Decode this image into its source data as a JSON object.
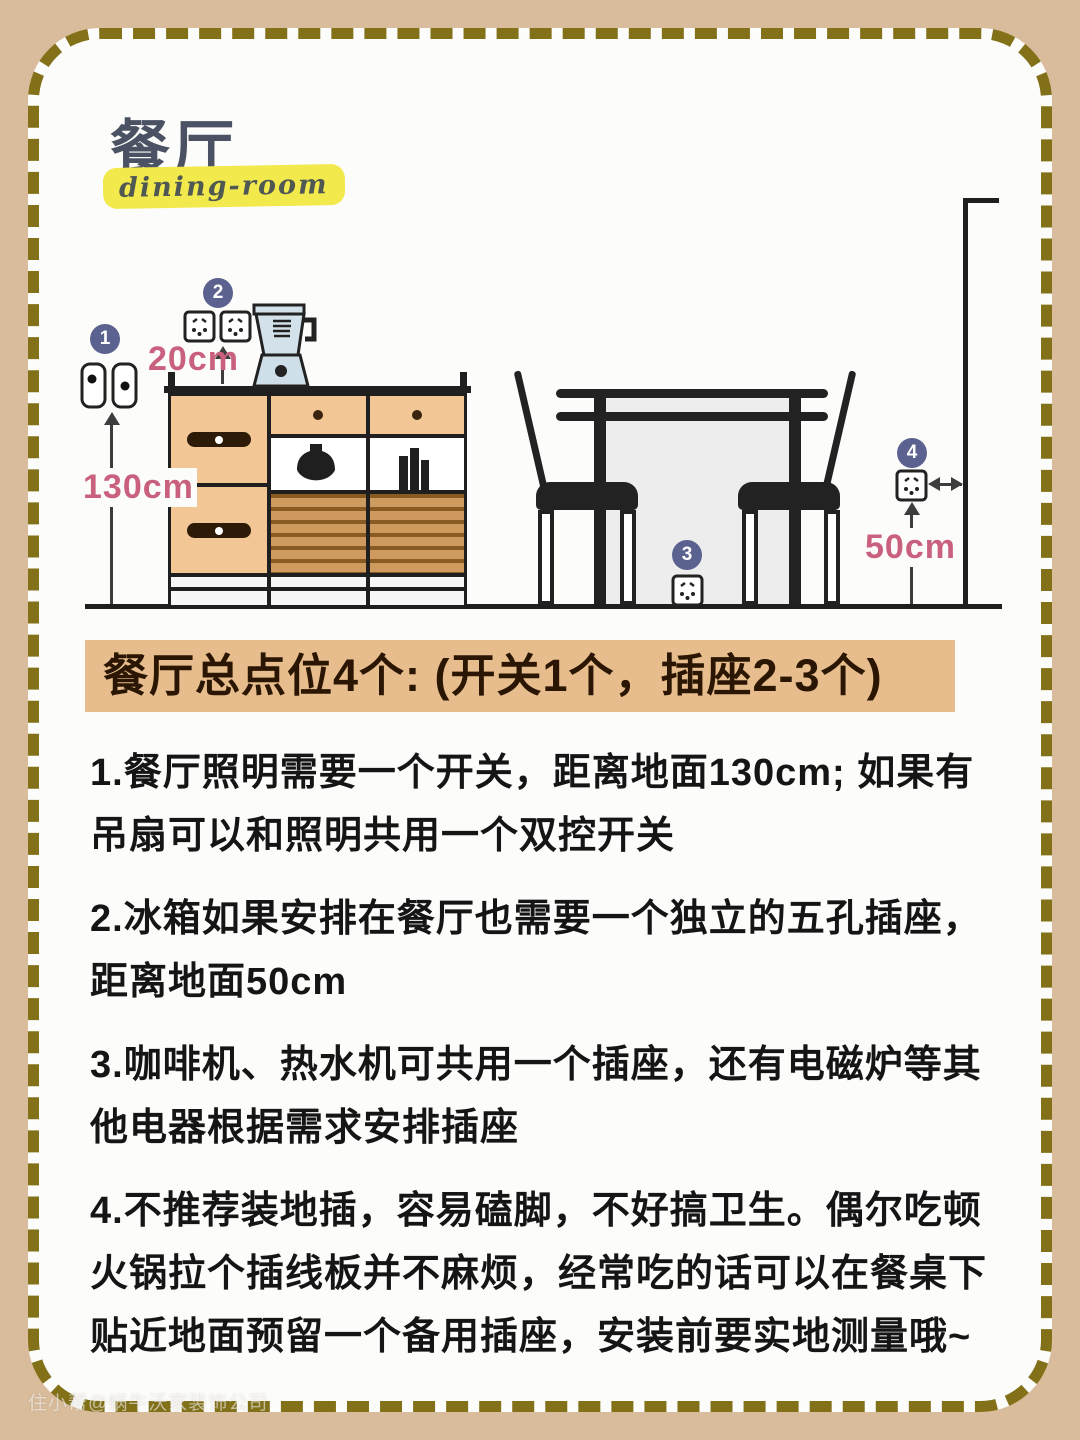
{
  "page": {
    "title": "餐厅",
    "subtitle": "dining-room",
    "watermark": "住小帮@蜗牛沃家装饰公司"
  },
  "banner": {
    "text": "餐厅总点位4个: (开关1个，插座2-3个)"
  },
  "diagram": {
    "markers": [
      {
        "num": "1",
        "meaning": "餐厅照明开关"
      },
      {
        "num": "2",
        "meaning": "柜上插座"
      },
      {
        "num": "3",
        "meaning": "餐桌下备用插座"
      },
      {
        "num": "4",
        "meaning": "冰箱五孔插座"
      }
    ],
    "measurements": {
      "switch_height": "130cm",
      "outlet_above_cabinet": "20cm",
      "fridge_outlet_height": "50cm"
    }
  },
  "notes": [
    "1.餐厅照明需要一个开关，距离地面130cm; 如果有\n吊扇可以和照明共用一个双控开关",
    "2.冰箱如果安排在餐厅也需要一个独立的五孔插座，\n距离地面50cm",
    "3.咖啡机、热水机可共用一个插座，还有电磁炉等其\n他电器根据需求安排插座",
    "4.不推荐装地插，容易磕脚，不好搞卫生。偶尔吃顿\n火锅拉个插线板并不麻烦，经常吃的话可以在餐桌下\n贴近地面预留一个备用插座，安装前要实地测量哦~"
  ],
  "colors": {
    "background": "#d8bc9c",
    "border_dash": "#827119",
    "accent_pink": "#c9607e",
    "marker_blue": "#5c6290",
    "banner_bg": "#e7bd8d",
    "cabinet_tan": "#f2c795",
    "highlight_yellow": "#f2e94c"
  }
}
